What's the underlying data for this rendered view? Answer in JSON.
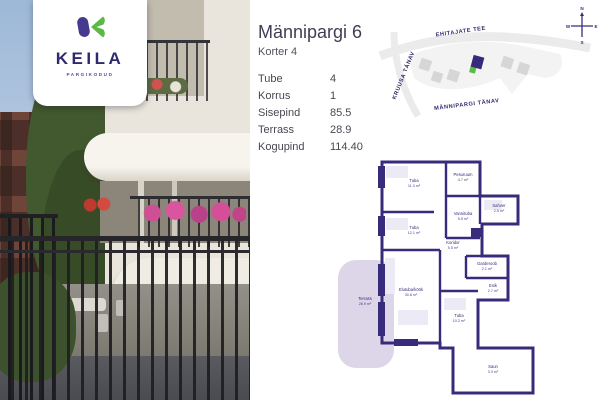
{
  "brand": {
    "name": "KEILA",
    "tagline": "PARGIKODUD"
  },
  "listing": {
    "title": "Männipargi 6",
    "subtitle": "Korter 4"
  },
  "details": {
    "rows": [
      {
        "label": "Tube",
        "value": "4"
      },
      {
        "label": "Korrus",
        "value": "1"
      },
      {
        "label": "Sisepind",
        "value": "85.5"
      },
      {
        "label": "Terrass",
        "value": "28.9"
      },
      {
        "label": "Kogupind",
        "value": "114.40"
      }
    ]
  },
  "map": {
    "streets": {
      "top": "EHITAJATE TEE",
      "left": "KRUUSA TÄNAV",
      "bottom": "MÄNNIPARGI TÄNAV"
    },
    "compass": {
      "n": "N",
      "e": "E",
      "s": "S",
      "w": "W"
    }
  },
  "floorplan": {
    "rooms": [
      {
        "name": "Tuba",
        "area": "11.3 m²"
      },
      {
        "name": "Pesuruum",
        "area": "4.7 m²"
      },
      {
        "name": "Sahver",
        "area": "2.5 m²"
      },
      {
        "name": "Vannituba",
        "area": "5.5 m²"
      },
      {
        "name": "Koridor",
        "area": "5.5 m²"
      },
      {
        "name": "Garderoob",
        "area": "2.1 m²"
      },
      {
        "name": "Esik",
        "area": "2.7 m²"
      },
      {
        "name": "Tuba",
        "area": "12.1 m²"
      },
      {
        "name": "Elutuba/köök",
        "area": "30.8 m²"
      },
      {
        "name": "Tuba",
        "area": "10.2 m²"
      },
      {
        "name": "Saun",
        "area": "3.3 m²"
      },
      {
        "name": "Terrass",
        "area": "28.9 m²"
      }
    ]
  },
  "colors": {
    "accent_purple": "#382b7b",
    "brand_green": "#5cb947",
    "brand_navy": "#2f2a6e",
    "terrace_lavender": "#dcd6e8",
    "map_gray": "#ebebeb"
  }
}
